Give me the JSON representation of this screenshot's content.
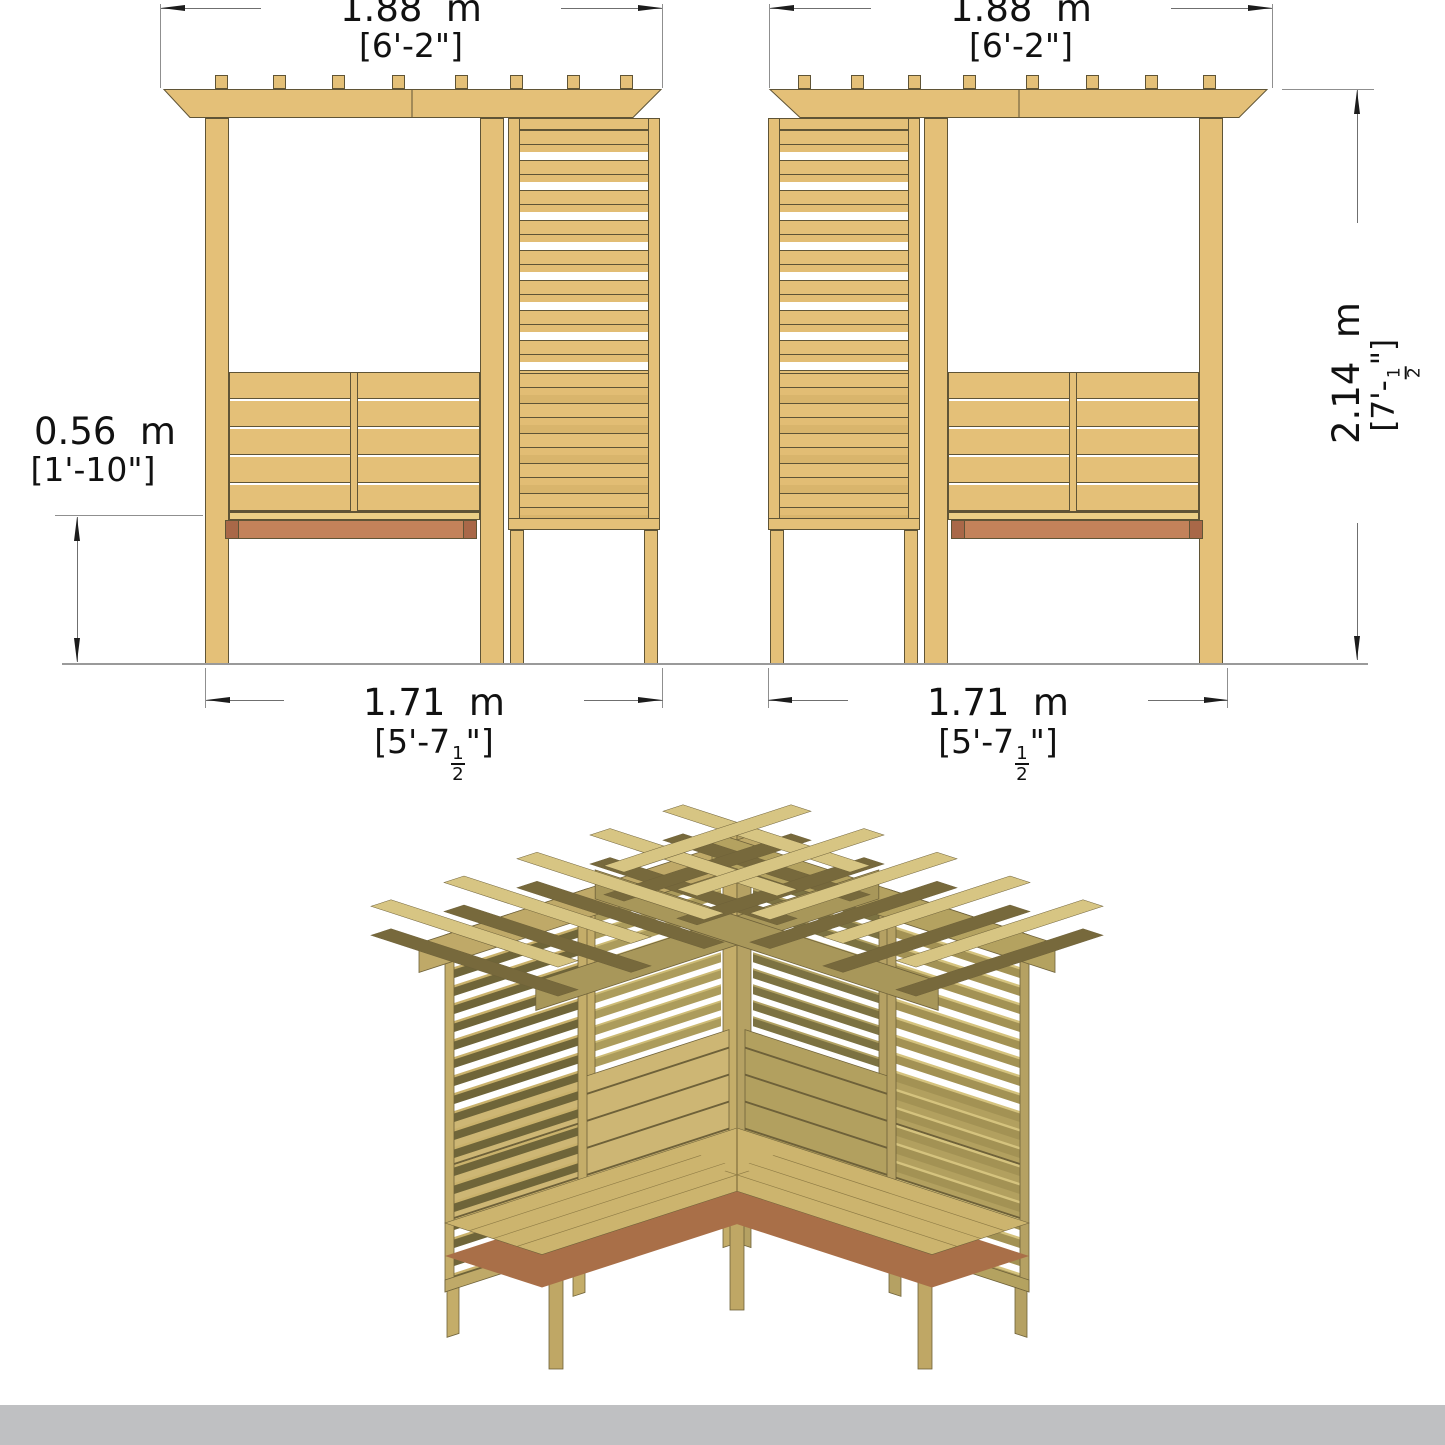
{
  "dims": {
    "top_left": {
      "metric": "1.88  m",
      "imperial": "[6'-2\"]"
    },
    "top_right": {
      "metric": "1.88  m",
      "imperial": "[6'-2\"]"
    },
    "height": {
      "metric": "2.14  m",
      "imperial_prefix": "[7'-",
      "imperial_frac_num": "1",
      "imperial_frac_den": "2",
      "imperial_suffix": "\"]"
    },
    "seat": {
      "metric": "0.56  m",
      "imperial": "[1'-10\"]"
    },
    "bottom_left": {
      "metric": "1.71  m",
      "imperial_prefix": "[5'-7",
      "imperial_frac_num": "1",
      "imperial_frac_den": "2",
      "imperial_suffix": "\"]"
    },
    "bottom_right": {
      "metric": "1.71  m",
      "imperial_prefix": "[5'-7",
      "imperial_frac_num": "1",
      "imperial_frac_den": "2",
      "imperial_suffix": "\"]"
    }
  },
  "colors": {
    "wood": "#e4c078",
    "wood_outline": "#5f5436",
    "wood_shaded": "#d9b56c",
    "seat_apron": "#c3825a",
    "apron_dark": "#a96848",
    "iso_dark_slat": "#6f6539",
    "iso_medium_wood": "#b2a05f",
    "iso_light_wood": "#cdb674",
    "iso_seat": "#ccb46e",
    "iso_skirt_red": "#a96f48",
    "ground_line": "#9a9a9a",
    "dimension_line": "#6f6f6f",
    "text": "#111111",
    "footer_gray": "#bfc0c2",
    "background": "#ffffff"
  }
}
